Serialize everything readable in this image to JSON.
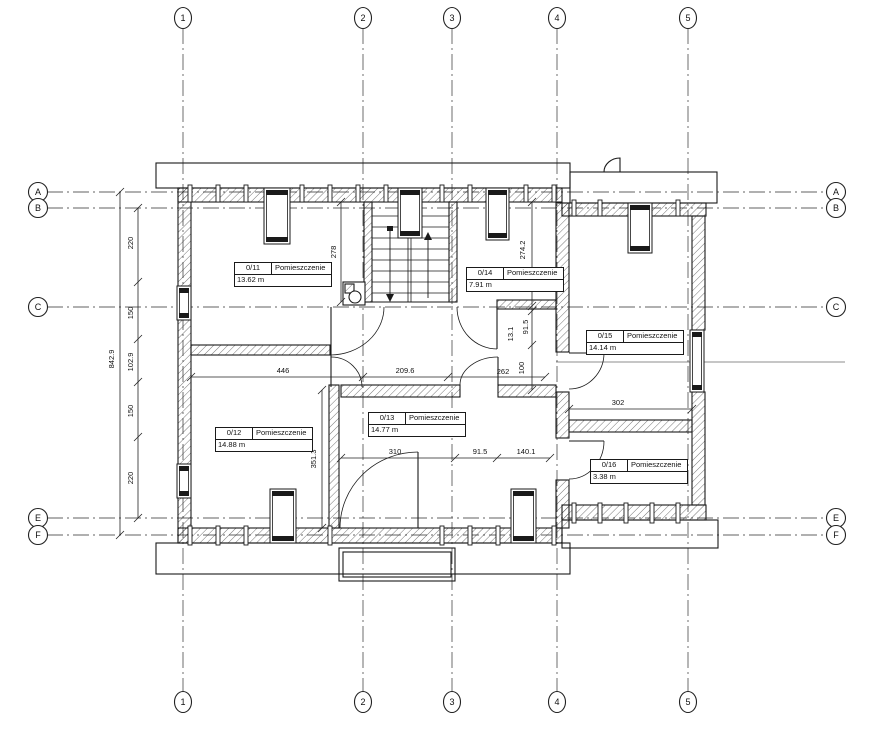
{
  "drawing": {
    "type": "architectural-floor-plan",
    "room_label_header": "Pomieszczenie"
  },
  "grid": {
    "columns": [
      {
        "label": "1",
        "x": 183
      },
      {
        "label": "2",
        "x": 363
      },
      {
        "label": "3",
        "x": 452
      },
      {
        "label": "4",
        "x": 557
      },
      {
        "label": "5",
        "x": 688
      }
    ],
    "rows": [
      {
        "label": "A",
        "y": 192
      },
      {
        "label": "B",
        "y": 208
      },
      {
        "label": "C",
        "y": 307
      },
      {
        "label": "E",
        "y": 518
      },
      {
        "label": "F",
        "y": 535
      }
    ]
  },
  "rooms": [
    {
      "id": "0/11",
      "name": "Pomieszczenie",
      "area": "13.62 m",
      "x": 234,
      "y": 262
    },
    {
      "id": "0/14",
      "name": "Pomieszczenie",
      "area": "7.91 m",
      "x": 466,
      "y": 267
    },
    {
      "id": "0/15",
      "name": "Pomieszczenie",
      "area": "14.14 m",
      "x": 586,
      "y": 330
    },
    {
      "id": "0/12",
      "name": "Pomieszczenie",
      "area": "14.88 m",
      "x": 215,
      "y": 427
    },
    {
      "id": "0/13",
      "name": "Pomieszczenie",
      "area": "14.77 m",
      "x": 368,
      "y": 412
    },
    {
      "id": "0/16",
      "name": "Pomieszczenie",
      "area": "3.38 m",
      "x": 590,
      "y": 459
    }
  ],
  "dimensions": {
    "horizontal": [
      {
        "text": "446",
        "x": 283,
        "y": 373
      },
      {
        "text": "209.6",
        "x": 405,
        "y": 373
      },
      {
        "text": "262",
        "x": 503,
        "y": 374
      },
      {
        "text": "310",
        "x": 395,
        "y": 454
      },
      {
        "text": "91.5",
        "x": 480,
        "y": 454
      },
      {
        "text": "140.1",
        "x": 526,
        "y": 454
      },
      {
        "text": "302",
        "x": 618,
        "y": 405
      }
    ],
    "vertical": [
      {
        "text": "278",
        "x": 336,
        "y": 252
      },
      {
        "text": "274.2",
        "x": 525,
        "y": 250
      },
      {
        "text": "91.5",
        "x": 528,
        "y": 327
      },
      {
        "text": "13.1",
        "x": 513,
        "y": 334
      },
      {
        "text": "100",
        "x": 524,
        "y": 368
      },
      {
        "text": "351.3",
        "x": 316,
        "y": 459
      },
      {
        "text": "842.9",
        "x": 114,
        "y": 359
      },
      {
        "text": "220",
        "x": 133,
        "y": 243
      },
      {
        "text": "150",
        "x": 133,
        "y": 313
      },
      {
        "text": "102.9",
        "x": 133,
        "y": 362
      },
      {
        "text": "150",
        "x": 133,
        "y": 411
      },
      {
        "text": "220",
        "x": 133,
        "y": 478
      }
    ]
  },
  "colors": {
    "line": "#1a1a1a",
    "grid": "#2f2f2f",
    "dim": "#111111"
  }
}
